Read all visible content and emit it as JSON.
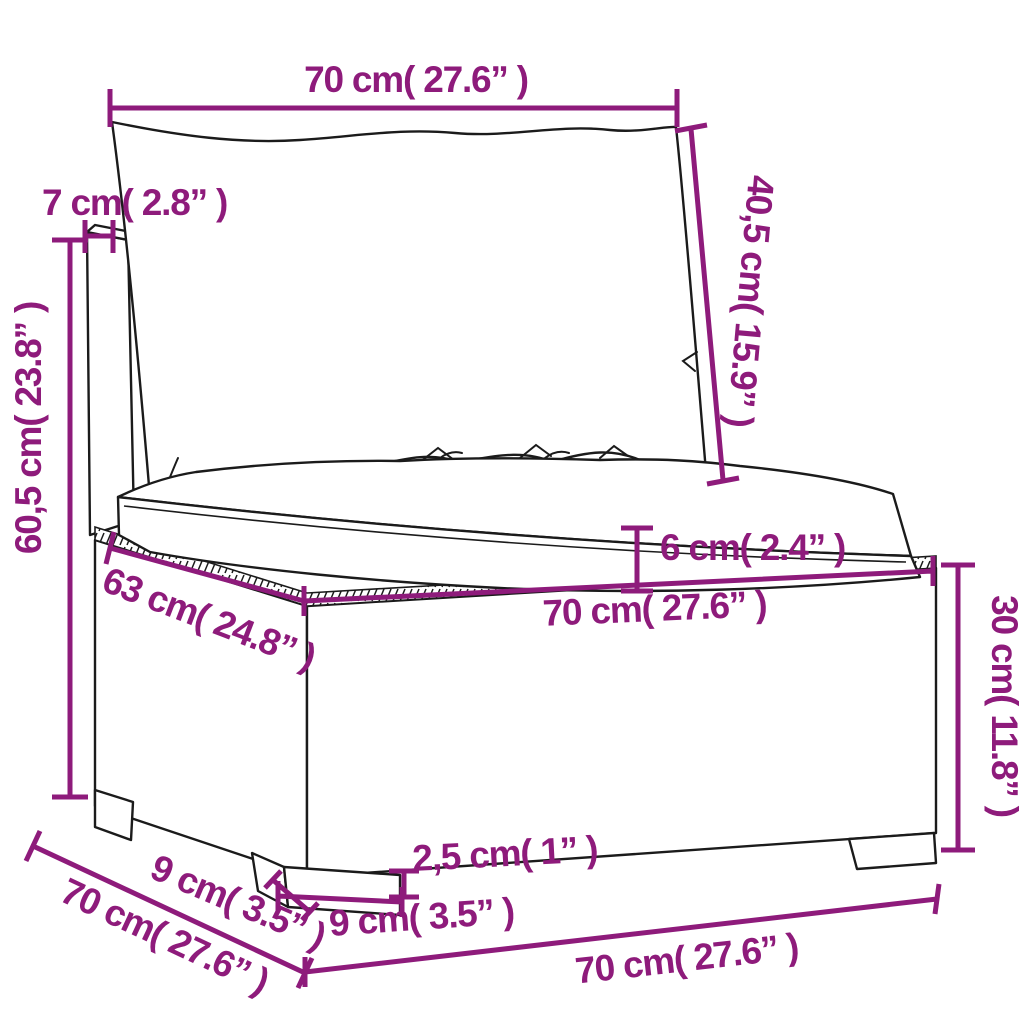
{
  "figure": {
    "description": "Line-art dimension diagram of a poly rattan garden sofa middle section with back cushion and seat cushion",
    "accent_color": "#8E1B7B",
    "line_color": "#1b1b1b",
    "background_color": "#ffffff"
  },
  "dimensions": {
    "back_width_top": {
      "label": "70 cm( 27.6” )"
    },
    "back_post_depth": {
      "label": "7 cm( 2.8” )"
    },
    "back_cushion_height": {
      "label": "40,5 cm( 15.9” )"
    },
    "overall_height": {
      "label": "60,5 cm( 23.8” )"
    },
    "seat_cushion_thickness": {
      "label": "6 cm( 2.4” )"
    },
    "seat_depth": {
      "label": "63 cm( 24.8” )"
    },
    "seat_width": {
      "label": "70 cm( 27.6” )"
    },
    "base_height": {
      "label": "30 cm( 11.8” )"
    },
    "base_depth_bottom": {
      "label": "70 cm( 27.6” )"
    },
    "leg_depth": {
      "label": "9 cm( 3.5” )"
    },
    "leg_height": {
      "label": "2,5 cm( 1” )"
    },
    "leg_width": {
      "label": "9 cm( 3.5” )"
    },
    "base_width_bottom": {
      "label": "70 cm( 27.6” )"
    }
  }
}
